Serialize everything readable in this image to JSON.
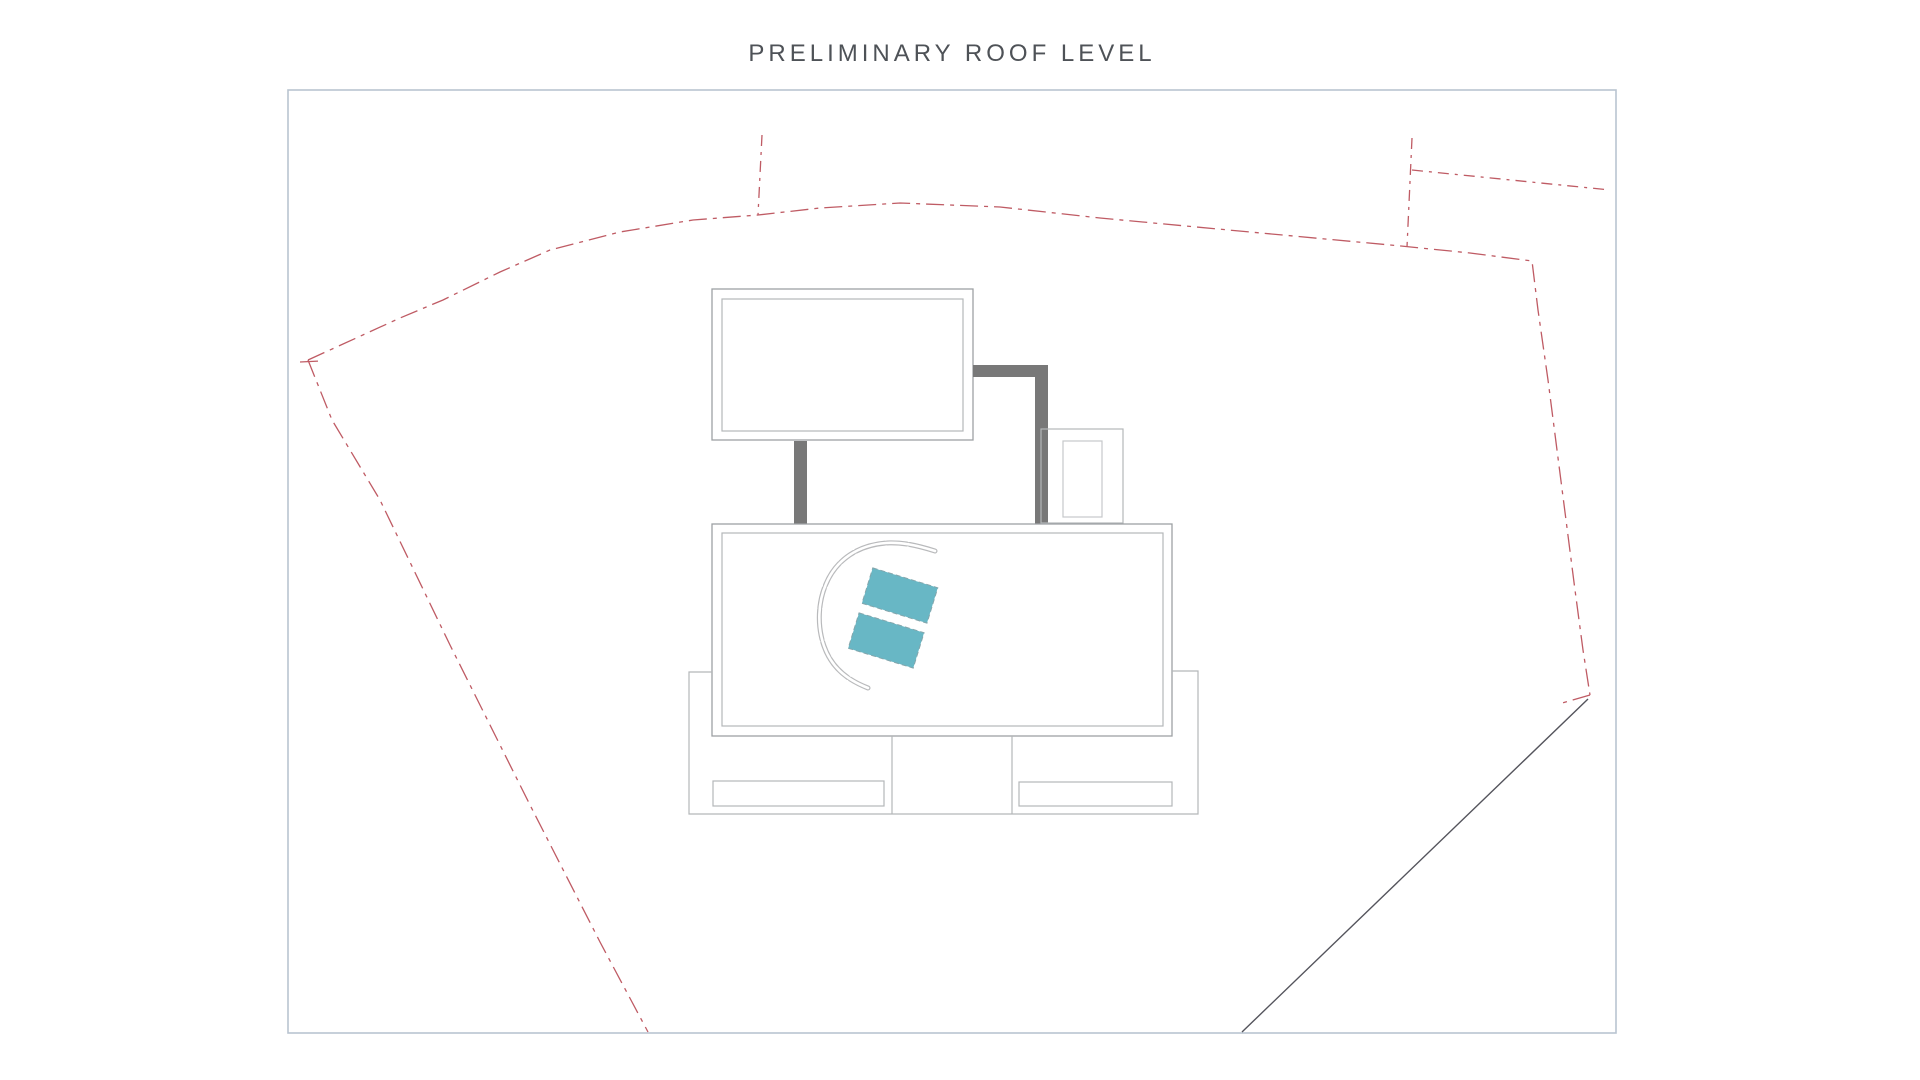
{
  "page": {
    "title": "PRELIMINARY ROOF LEVEL"
  },
  "colors": {
    "background": "#ffffff",
    "title_text": "#4e5257",
    "frame_border": "#b9c4d0",
    "boundary_red": "#bf5b64",
    "survey_line_dark": "#54545c",
    "plan_line": "#9da1a4",
    "plan_line_light": "#b4b7b9",
    "plan_line_faint": "#c6c8ca",
    "wall_fill": "#787878",
    "skylight_fill": "#68b7c5",
    "skylight_stroke": "#84a6ac",
    "arc_stroke": "#b9babc"
  }
}
